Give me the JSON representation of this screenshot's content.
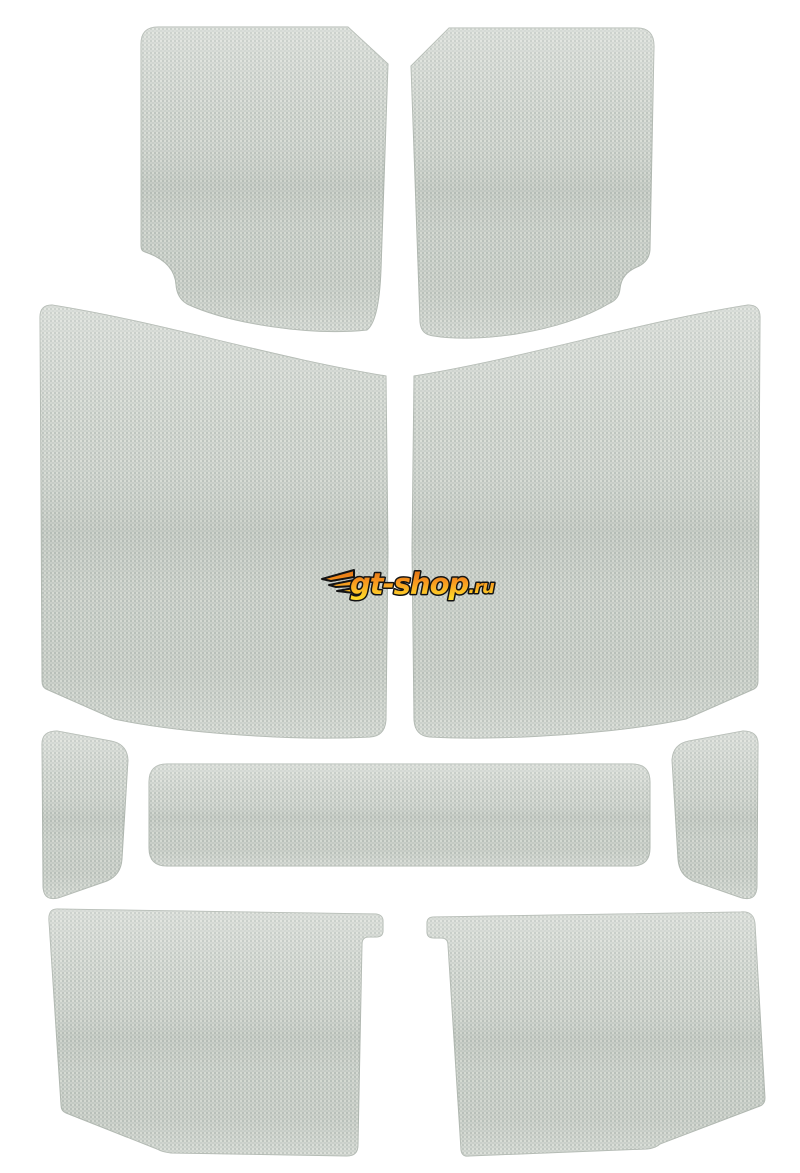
{
  "image": {
    "type": "product-photo",
    "subject": "Automotive headliner sound-deadening kit: nine light gray woven fabric panels laid out flat on a white background",
    "piece_count": 9,
    "background_color": "#ffffff"
  },
  "fabric": {
    "texture": "woven canvas",
    "base_color": "#c8cec8",
    "weave_light": "#dadeD7",
    "weave_mid": "#cfd4ce",
    "weave_dark": "#bcc3bd",
    "edge_color": "#b2b9b2"
  },
  "watermark": {
    "text": "gt-shop",
    "suffix": ".ru",
    "full_text": "gt-shop.ru",
    "gradient_top": "#da660f",
    "gradient_mid": "#f6921e",
    "gradient_bottom": "#ffd92a",
    "outline_color": "#141414"
  },
  "pieces": [
    {
      "name": "front-left-door-panel",
      "position": "top-left"
    },
    {
      "name": "front-right-door-panel",
      "position": "top-right"
    },
    {
      "name": "left-side-large-panel",
      "position": "middle-left"
    },
    {
      "name": "right-side-large-panel",
      "position": "middle-right"
    },
    {
      "name": "left-small-side-panel",
      "position": "center-left"
    },
    {
      "name": "center-header-bar",
      "position": "center"
    },
    {
      "name": "right-small-side-panel",
      "position": "center-right"
    },
    {
      "name": "rear-left-panel",
      "position": "bottom-left"
    },
    {
      "name": "rear-right-panel",
      "position": "bottom-right"
    }
  ]
}
